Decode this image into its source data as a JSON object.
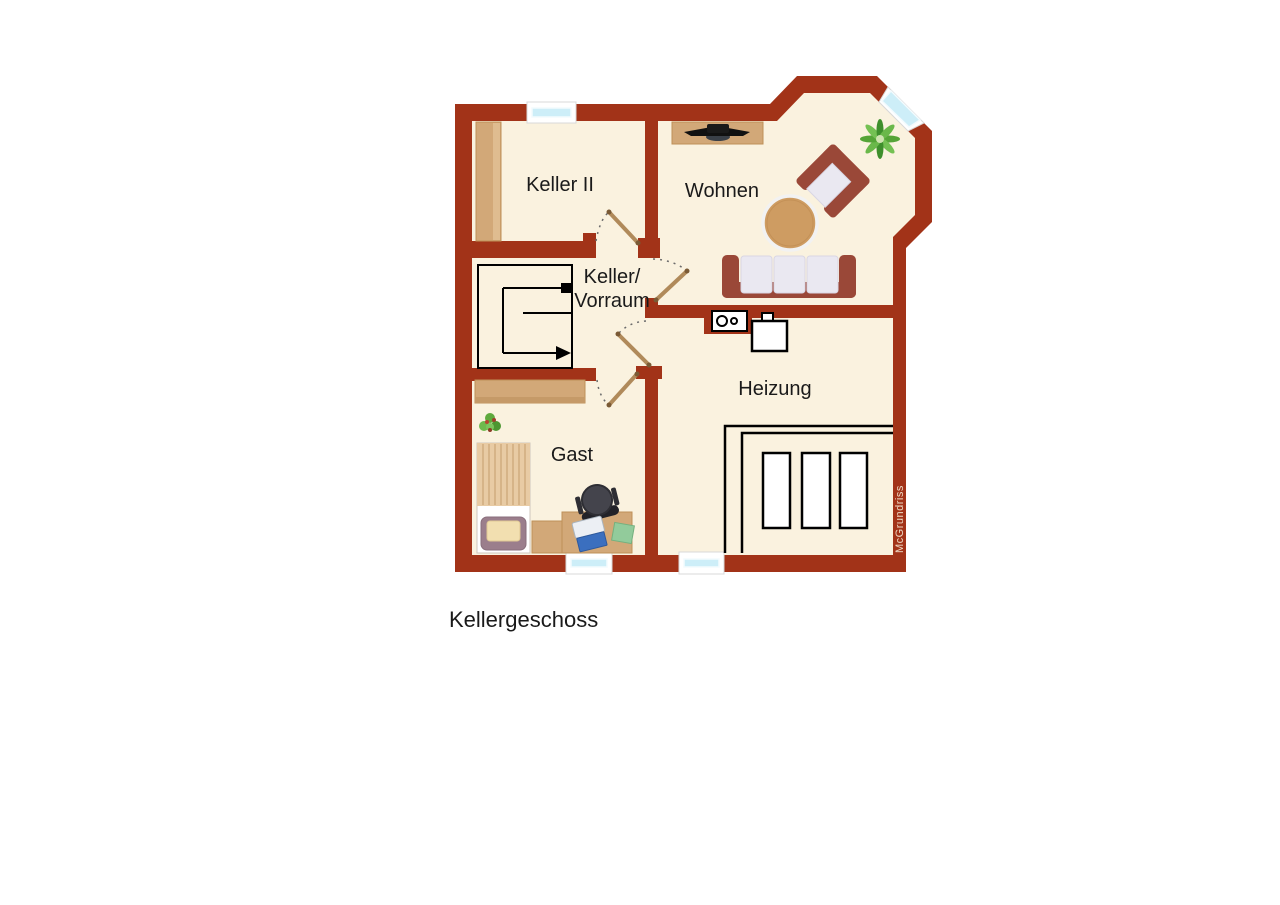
{
  "title": {
    "label": "Kellergeschoss"
  },
  "watermark": {
    "label": "McGrundriss"
  },
  "floorplan": {
    "level": "basement",
    "rooms": {
      "keller2": {
        "label": "Keller II"
      },
      "wohnen": {
        "label": "Wohnen"
      },
      "vorraum": {
        "label_line1": "Keller/",
        "label_line2": "Vorraum"
      },
      "heizung": {
        "label": "Heizung"
      },
      "gast": {
        "label": "Gast"
      }
    },
    "furniture": [
      "cabinet",
      "sideboard-tv",
      "plant-large",
      "armchair",
      "coffee-table",
      "sofa",
      "meter-box",
      "boiler",
      "heating-tanks",
      "stairs",
      "sideboard",
      "plant-small",
      "bed",
      "nightstand",
      "desk",
      "office-chair",
      "laptop",
      "notepad"
    ],
    "colors": {
      "wall": "#a23318",
      "floor": "#faf2df",
      "window_glass": "#cdeef8",
      "wood": "#d2a878",
      "door": "#b08a5a",
      "sofa_frame": "#9a4838",
      "cushion": "#eae8f1",
      "plant": "#5fa93d",
      "outline": "#000000",
      "background": "#ffffff",
      "label_text": "#1a1a1a",
      "watermark_text": "#eed9c4"
    }
  }
}
